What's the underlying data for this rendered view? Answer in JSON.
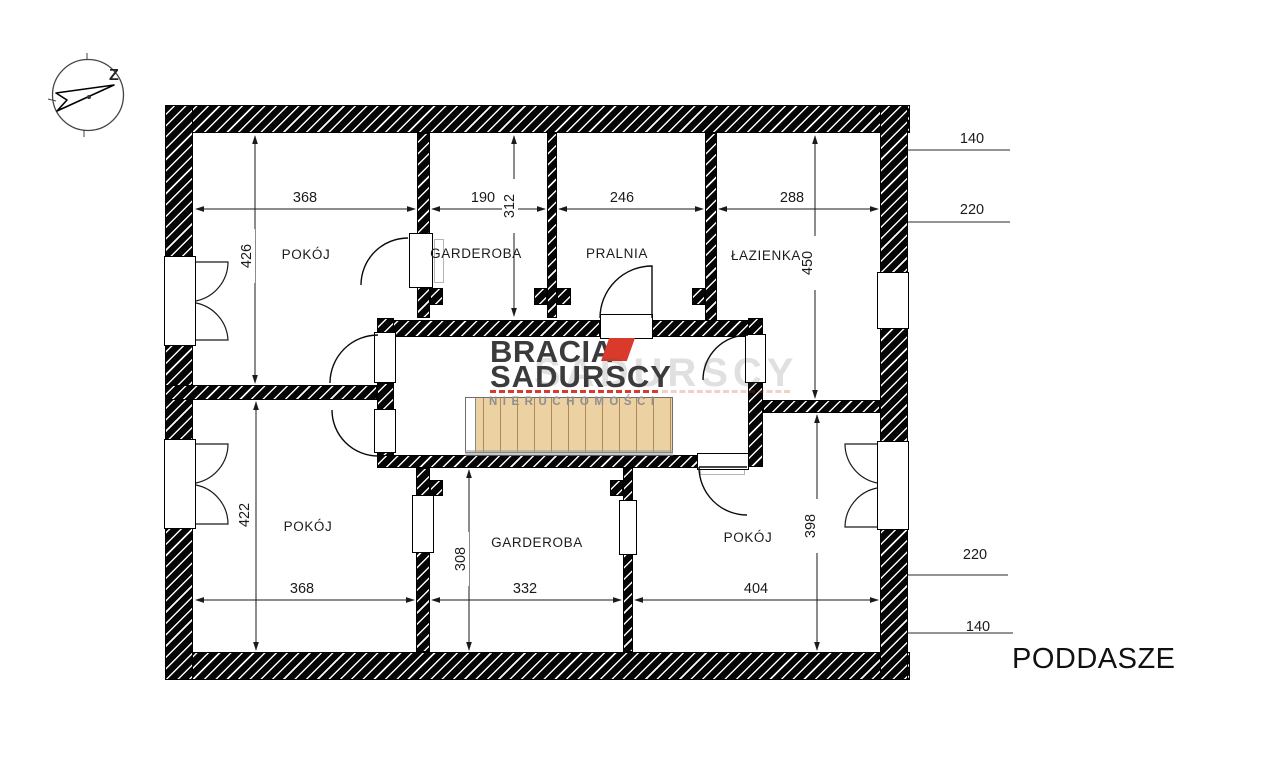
{
  "plan": {
    "floor_label": "PODDASZE",
    "compass_label": "Z"
  },
  "logo": {
    "line1": "BRACIA",
    "line2": "SADURSCY",
    "tagline": "NIERUCHOMOŚCI",
    "watermark": "SADURSCY",
    "accent_color": "#D93A2B",
    "ink_color": "#3B3B3D",
    "tagline_color": "#8F8F8F"
  },
  "rooms": {
    "pokoj_tl": {
      "label": "POKÓJ",
      "width_cm": "368",
      "height_cm": "426"
    },
    "garderoba_t": {
      "label": "GARDEROBA",
      "width_cm": "190",
      "height_cm": "312"
    },
    "pralnia": {
      "label": "PRALNIA",
      "width_cm": "246"
    },
    "lazienka": {
      "label": "ŁAZIENKA",
      "width_cm": "288",
      "height_cm": "450"
    },
    "pokoj_bl": {
      "label": "POKÓJ",
      "width_cm": "368",
      "height_cm": "422"
    },
    "garderoba_b": {
      "label": "GARDEROBA",
      "width_cm": "332",
      "height_cm": "308"
    },
    "pokoj_br": {
      "label": "POKÓJ",
      "width_cm": "404",
      "height_cm": "398"
    }
  },
  "side_annotations": {
    "top_first": "140",
    "top_second": "220",
    "bottom_first": "220",
    "bottom_second": "140"
  }
}
